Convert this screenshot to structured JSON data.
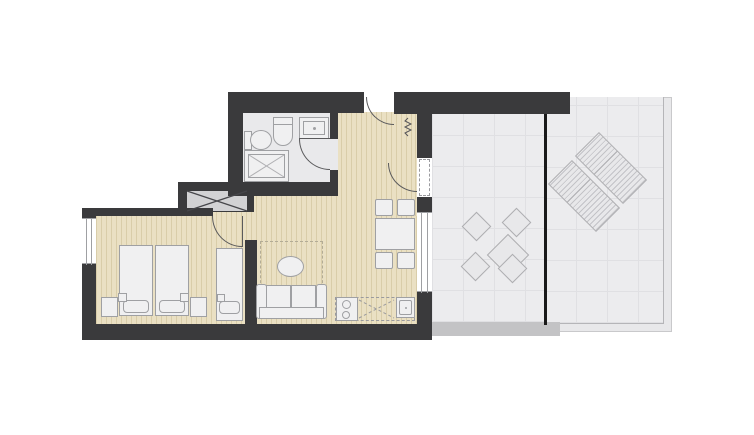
{
  "title": "Apartment floor plan with terrace",
  "colors": {
    "wall": "#3a3a3c",
    "wood": "#eae0c3",
    "wood_stripe": "#d9cda9",
    "bath_floor": "#e9e9eb",
    "terrace": "#ececee",
    "terrace_line": "#e0e0e3",
    "terrace_edge": "#c3c3c5",
    "fixture_fill": "#f0f0f1",
    "fixture_line": "#9fa0a3",
    "shaft_fill": "#d2d2d4",
    "divider": "#1a1a1a",
    "outdoor_fill": "#e8e8ea",
    "outdoor_line": "#aeaeb1",
    "door_line": "#5a5a5c",
    "rug_line": "#b3ac96"
  },
  "rooms": [
    {
      "name": "bathroom",
      "floor": "tile-gray",
      "fixtures": [
        "toilet",
        "bidet",
        "washbasin",
        "shower"
      ]
    },
    {
      "name": "entry-hall",
      "floor": "wood",
      "features": [
        "entrance-door",
        "service-shaft",
        "riser-symbol"
      ]
    },
    {
      "name": "bedroom",
      "floor": "wood",
      "furniture": [
        "double-bed",
        "single-bed",
        "nightstand-left",
        "nightstand-right"
      ],
      "openings": [
        "window-left",
        "door-to-hall"
      ]
    },
    {
      "name": "living-room-kitchen",
      "floor": "wood",
      "furniture": [
        "sofa",
        "rug",
        "coffee-table",
        "dining-table",
        "dining-chairs-x4",
        "kitchen-counter",
        "cooktop",
        "kitchen-sink"
      ],
      "openings": [
        "window-right",
        "terrace-door"
      ]
    },
    {
      "name": "terrace",
      "floor": "tile-grid",
      "furniture": [
        "patio-table",
        "patio-chairs-x4",
        "sun-lounger-x2"
      ],
      "features": [
        "glass-divider",
        "edge-strip"
      ]
    }
  ]
}
